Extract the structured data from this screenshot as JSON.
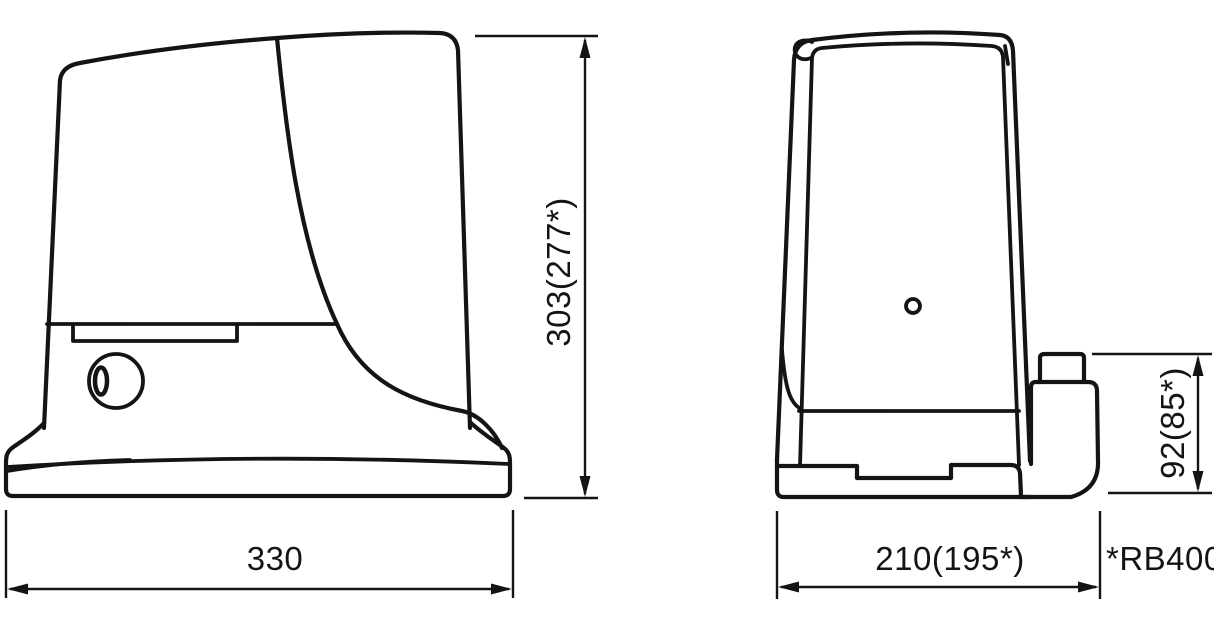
{
  "colors": {
    "line": "#141414",
    "background": "#ffffff"
  },
  "views": {
    "side": {
      "height_label": "303(277*)",
      "width_label": "330"
    },
    "front": {
      "width_label": "210(195*)",
      "height_label": "92(85*)"
    }
  },
  "note": "*RB400"
}
